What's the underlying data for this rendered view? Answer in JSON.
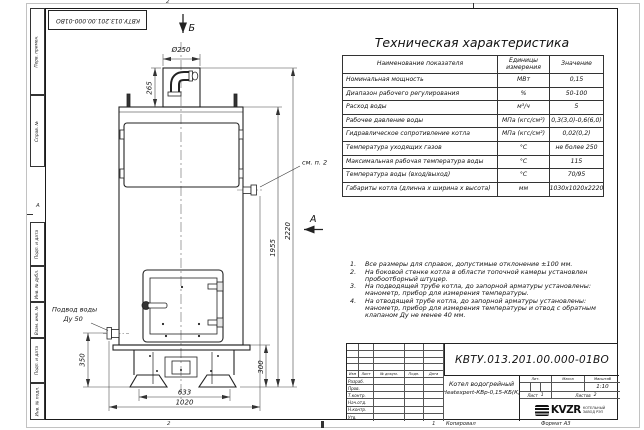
{
  "sheet": {
    "paper_color": "#ffffff",
    "line_color": "#222222",
    "top_stamp": "КВТУ.013.201.00.000-01ВО",
    "margin_labels": [
      "Перв. примен.",
      "Справ. №",
      "Подп. и дата",
      "Инв. № дубл.",
      "Взам. инв. №",
      "Подп. и дата",
      "Инв. № подл."
    ],
    "zone_top": "2",
    "zone_bottom_left": "2",
    "zone_bottom_right": "1",
    "zone_row_letter": "А",
    "copied_label": "Копировал",
    "format_label": "Формат А3"
  },
  "spec_table": {
    "title": "Техническая характеристика",
    "headers": [
      "Наименование показателя",
      "Единицы измерения",
      "Значение"
    ],
    "rows": [
      [
        "Номинальная мощность",
        "МВт",
        "0,15"
      ],
      [
        "Диапазон рабочего регулирования",
        "%",
        "50-100"
      ],
      [
        "Расход воды",
        "м³/ч",
        "5"
      ],
      [
        "Рабочее давление воды",
        "МПа (кгс/см²)",
        "0,3(3,0)-0,6(6,0)"
      ],
      [
        "Гидравлическое сопротивление котла",
        "МПа (кгс/см²)",
        "0,02(0,2)"
      ],
      [
        "Температура уходящих газов",
        "°С",
        "не более 250"
      ],
      [
        "Максимальная рабочая температура воды",
        "°С",
        "115"
      ],
      [
        "Температура воды (вход/выход)",
        "°С",
        "70/95"
      ],
      [
        "Габариты котла (длинна х ширина х высота)",
        "мм",
        "1030х1020х2220"
      ]
    ]
  },
  "notes": {
    "items": [
      {
        "num": "1.",
        "text": "Все размеры для справок, допустимые отклонение ±100 мм."
      },
      {
        "num": "2.",
        "text": "На боковой стенке котла в области топочной камеры установлен пробоотборный штуцер."
      },
      {
        "num": "3.",
        "text": "На подводящей трубе котла, до запорной арматуры установлены: манометр, прибор для измерения температуры."
      },
      {
        "num": "4.",
        "text": "На отводящей трубе котла, до запорной арматуры установлены: манометр, прибор для измерения температуры и отвод с обратным клапаном Ду не менее 40 мм."
      }
    ]
  },
  "title_block": {
    "doc_number": "КВТУ.013.201.00.000-01ВО",
    "product_name_line1": "Котел водогрейный",
    "product_name_line2": "Heatexpert-КВр-0,15-КБ(К)",
    "header_cols": [
      "Изм",
      "Лист",
      "№ докум.",
      "Подп.",
      "Дата"
    ],
    "sig_rows": [
      "Разраб.",
      "Пров.",
      "Т.контр.",
      "Нач.отд.",
      "Н.контр.",
      "Утв."
    ],
    "lit_label": "Лит.",
    "mass_label": "Масса",
    "scale_label": "Масштаб",
    "scale_value": "1:10",
    "sheet_label": "Лист",
    "sheet_value": "1",
    "sheets_label": "Листов",
    "sheets_value": "2",
    "logo": {
      "text": "KVZR",
      "sub_line1": "КОТЕЛЬНЫЙ",
      "sub_line2": "ЗАВОД РЭП"
    }
  },
  "drawing": {
    "section_b": "Б",
    "section_a": "А",
    "dims": {
      "chimney_diameter": "Ø250",
      "chimney_height": "265",
      "body_height": "1955",
      "total_height": "2220",
      "base_height": "300",
      "inlet_height": "350",
      "base_width": "633",
      "total_width": "1020"
    },
    "callout_see_note": "см. п. 2",
    "water_supply_line1": "Подвод воды",
    "water_supply_line2": "Ду 50"
  }
}
